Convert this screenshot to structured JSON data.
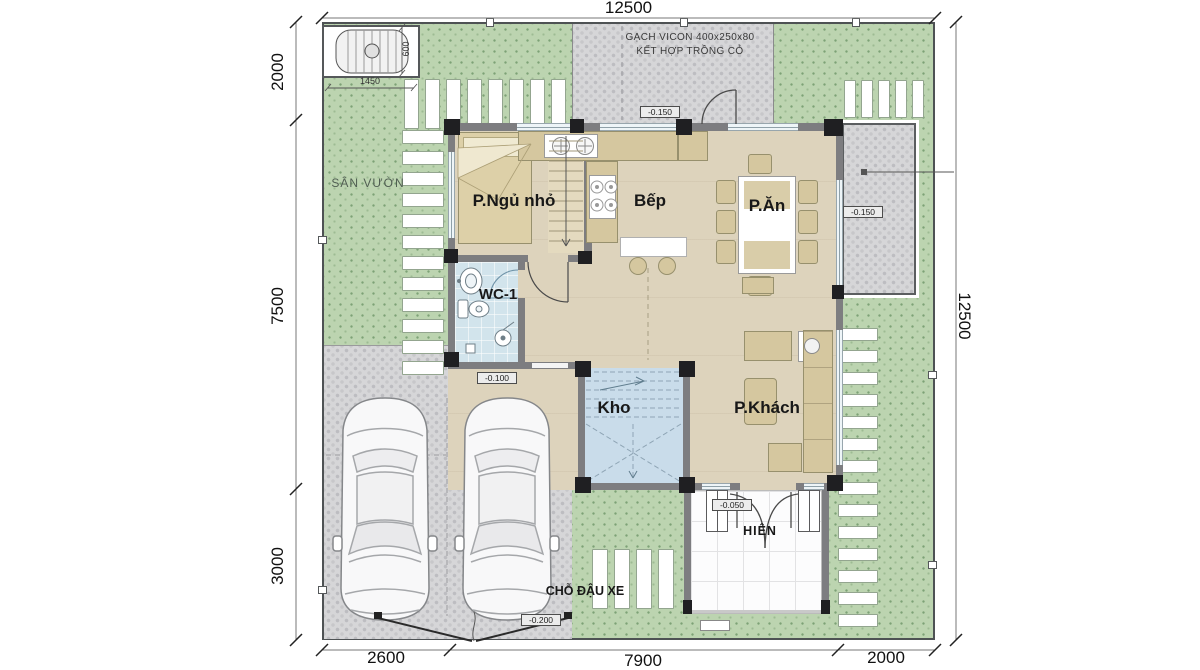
{
  "plan_title": "floor-plan",
  "dims": {
    "top": "12500",
    "right": "12500",
    "left": [
      "2000",
      "7500",
      "3000"
    ],
    "bottom": [
      "2600",
      "7900",
      "2000"
    ],
    "septic_w": "1450",
    "septic_h": "600"
  },
  "rooms": {
    "bedroom": "P.Ngủ nhỏ",
    "kitchen": "Bếp",
    "dining": "P.Ăn",
    "wc": "WC-1",
    "storage": "Kho",
    "living": "P.Khách",
    "porch": "HIÊN",
    "garden": "SÂN VƯỜN",
    "parking": "CHỖ ĐẬU XE"
  },
  "note": {
    "line1": "GẠCH VICON 400x250x80",
    "line2": "KẾT HỢP TRỒNG CỎ"
  },
  "elev": {
    "backyard": "-0.150",
    "patio": "-0.150",
    "hall": "-0.100",
    "porch": "-0.050",
    "parking": "-0.200"
  },
  "colors": {
    "grass": "#bcd4b0",
    "gravel": "#d6d6d8",
    "floor": "#ddd3bc",
    "wc_floor": "#d2e4ec",
    "storage_floor": "#c9dcea",
    "wall": "#7d7d80",
    "column": "#1f1f22",
    "furniture": "#d5c79f"
  }
}
